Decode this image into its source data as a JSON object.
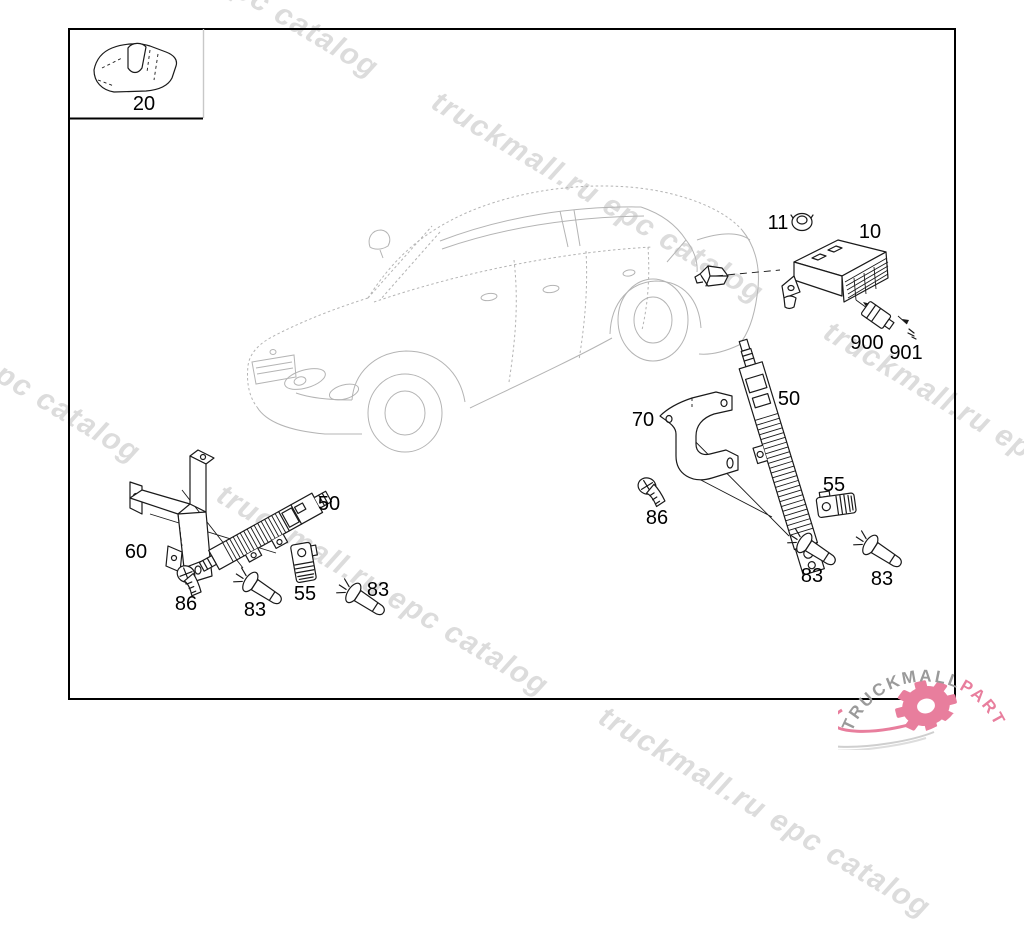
{
  "watermark": {
    "text": "truckmall.ru epc catalog",
    "color": "#dcdcdc"
  },
  "diagram": {
    "labels": {
      "inset_clip": "20",
      "grommet": "11",
      "control_module": "10",
      "connector": "900",
      "connector_pin": "901",
      "bracket_right": "70",
      "amplifier_right": "50",
      "clip_right": "55",
      "screw_right": "86",
      "bolt_right_1": "83",
      "bolt_right_2": "83",
      "bracket_left": "60",
      "amplifier_left": "50",
      "screw_left": "86",
      "bolt_left_1": "83",
      "clip_left": "55",
      "bolt_left_2": "83"
    }
  },
  "logo": {
    "brand": "TRUCKMALL",
    "brand_suffix": "PARTS",
    "gray": "#9a9a9a",
    "pink": "#e87e9d"
  },
  "colors": {
    "part_line": "#1a1a1a",
    "car_line": "#b4b4b4",
    "frame": "#000000",
    "watermark": "#dcdcdc"
  }
}
